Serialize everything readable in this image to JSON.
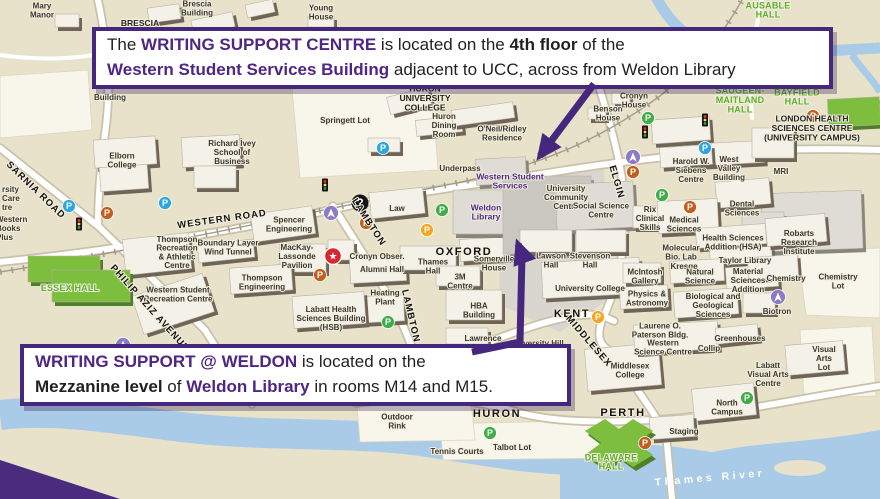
{
  "colors": {
    "purple": "#4F2683",
    "callout_border": "#46277E",
    "map_bg": "#E9E2CB",
    "river": "#A9CBE8",
    "green_label": "#5FAE2C",
    "building_shadow": "#6F6455",
    "parking_blue": "#2EA7E0",
    "parking_orange": "#C05F1E",
    "parking_yellow": "#F5A623",
    "parking_green": "#3FAE49",
    "info_purple": "#8B7CC4",
    "star_red": "#D7282F"
  },
  "callouts": {
    "top": {
      "lines": [
        [
          {
            "t": "The ",
            "s": "n"
          },
          {
            "t": "WRITING SUPPORT CENTRE",
            "s": "pb"
          },
          {
            "t": " is located on the ",
            "s": "n"
          },
          {
            "t": "4th floor",
            "s": "b"
          },
          {
            "t": " of the",
            "s": "n"
          }
        ],
        [
          {
            "t": "Western Student Services Building",
            "s": "pb"
          },
          {
            "t": " adjacent to UCC, across from Weldon Library",
            "s": "n"
          }
        ]
      ]
    },
    "bottom": {
      "lines": [
        [
          {
            "t": "WRITING SUPPORT @ WELDON",
            "s": "pb"
          },
          {
            "t": " is located on the",
            "s": "n"
          }
        ],
        [
          {
            "t": "Mezzanine level",
            "s": "b"
          },
          {
            "t": " of ",
            "s": "n"
          },
          {
            "t": "Weldon Library",
            "s": "pb"
          },
          {
            "t": " in rooms M14 and M15.",
            "s": "n"
          }
        ]
      ]
    }
  },
  "map_labels": [
    {
      "t": "Mary\nManor",
      "x": 42,
      "y": 10
    },
    {
      "t": "BRESCIA",
      "x": 140,
      "y": 23,
      "c": "bldgb"
    },
    {
      "t": "Brescia\nBuilding",
      "x": 197,
      "y": 8
    },
    {
      "t": "Young\nHouse",
      "x": 321,
      "y": 12
    },
    {
      "t": "Building",
      "x": 110,
      "y": 97
    },
    {
      "t": "AUSABLE\nHALL",
      "x": 768,
      "y": 10,
      "c": "green"
    },
    {
      "t": "SAUGEEN-\nMAITLAND\nHALL",
      "x": 740,
      "y": 100,
      "c": "green"
    },
    {
      "t": "BAYFIELD\nHALL",
      "x": 797,
      "y": 97,
      "c": "green"
    },
    {
      "t": "LONDON HEALTH\nSCIENCES CENTRE\n(UNIVERSITY CAMPUS)",
      "x": 812,
      "y": 128,
      "c": "bldgb"
    },
    {
      "t": "MRI",
      "x": 781,
      "y": 171
    },
    {
      "t": "West\nValley\nBuilding",
      "x": 729,
      "y": 168
    },
    {
      "t": "Harold W.\nSiebens\nCentre",
      "x": 691,
      "y": 170
    },
    {
      "t": "HURON\nUNIVERSITY\nCOLLEGE",
      "x": 425,
      "y": 98,
      "c": "bldgb"
    },
    {
      "t": "Springett Lot",
      "x": 345,
      "y": 120
    },
    {
      "t": "Huron\nDining\nRoom",
      "x": 444,
      "y": 125
    },
    {
      "t": "O'Neil/Ridley\nResidence",
      "x": 502,
      "y": 133
    },
    {
      "t": "Underpass",
      "x": 460,
      "y": 168
    },
    {
      "t": "Benson\nHouse",
      "x": 608,
      "y": 113
    },
    {
      "t": "Cronyn\nHouse",
      "x": 634,
      "y": 100
    },
    {
      "t": "Western Student\nServices",
      "x": 510,
      "y": 181,
      "c": "purple"
    },
    {
      "t": "University\nCommunity\nCentre",
      "x": 566,
      "y": 197
    },
    {
      "t": "Weldon\nLibrary",
      "x": 486,
      "y": 212,
      "c": "purple"
    },
    {
      "t": "Social Science\nCentre",
      "x": 601,
      "y": 210
    },
    {
      "t": "rsity\nCare\ntre",
      "x": 2,
      "y": 198,
      "c": "anchor-s"
    },
    {
      "t": "Western\nBooks\nPlus",
      "x": -4,
      "y": 228,
      "c": "anchor-s"
    },
    {
      "t": "Elborn\nCollege",
      "x": 122,
      "y": 160
    },
    {
      "t": "Richard Ivey\nSchool of\nBusiness",
      "x": 232,
      "y": 152
    },
    {
      "t": "Spencer\nEngineering",
      "x": 289,
      "y": 224
    },
    {
      "t": "Boundary Layer\nWind Tunnel",
      "x": 228,
      "y": 247
    },
    {
      "t": "Thompson\nRecreation\n& Athletic\nCentre",
      "x": 177,
      "y": 252
    },
    {
      "t": "MacKay-\nLassonde\nPavilion",
      "x": 297,
      "y": 256
    },
    {
      "t": "Thompson\nEngineering",
      "x": 262,
      "y": 282
    },
    {
      "t": "Western Student\nRecreation Centre",
      "x": 178,
      "y": 294
    },
    {
      "t": "Cronyn Obser.",
      "x": 377,
      "y": 256
    },
    {
      "t": "Alumni Hall",
      "x": 382,
      "y": 269
    },
    {
      "t": "Law",
      "x": 397,
      "y": 208
    },
    {
      "t": "Heating\nPlant",
      "x": 385,
      "y": 297
    },
    {
      "t": "Labatt Health\nSciences Building\n(HSB)",
      "x": 331,
      "y": 318
    },
    {
      "t": "ESSEX HALL",
      "x": 70,
      "y": 288,
      "c": "green"
    },
    {
      "t": "Thames\nHall",
      "x": 433,
      "y": 266
    },
    {
      "t": "3M\nCentre",
      "x": 460,
      "y": 281
    },
    {
      "t": "Somerville\nHouse",
      "x": 494,
      "y": 263
    },
    {
      "t": "HBA\nBuilding",
      "x": 479,
      "y": 310
    },
    {
      "t": "Lawrence",
      "x": 483,
      "y": 338
    },
    {
      "t": "University Hill",
      "x": 537,
      "y": 343
    },
    {
      "t": "Lawson\nHall",
      "x": 551,
      "y": 260
    },
    {
      "t": "Stevenson\nHall",
      "x": 590,
      "y": 260
    },
    {
      "t": "University College",
      "x": 590,
      "y": 288
    },
    {
      "t": "Rix\nClinical\nSkills",
      "x": 650,
      "y": 218
    },
    {
      "t": "Medical\nSciences",
      "x": 684,
      "y": 224
    },
    {
      "t": "Dental\nSciences",
      "x": 742,
      "y": 208
    },
    {
      "t": "Health Sciences\nAddition (HSA)",
      "x": 733,
      "y": 242
    },
    {
      "t": "Molecular\nBio. Lab",
      "x": 681,
      "y": 252
    },
    {
      "t": "Kresge",
      "x": 684,
      "y": 266
    },
    {
      "t": "Taylor Library",
      "x": 745,
      "y": 260
    },
    {
      "t": "Natural\nScience",
      "x": 700,
      "y": 276
    },
    {
      "t": "Material\nSciences\nAddition",
      "x": 748,
      "y": 280
    },
    {
      "t": "McIntosh\nGallery",
      "x": 645,
      "y": 276
    },
    {
      "t": "Physics &\nAstronomy",
      "x": 647,
      "y": 298
    },
    {
      "t": "Biological and\nGeological\nSciences",
      "x": 713,
      "y": 305
    },
    {
      "t": "Chemistry",
      "x": 786,
      "y": 278
    },
    {
      "t": "Chemistry\nLot",
      "x": 838,
      "y": 281
    },
    {
      "t": "Robarts\nResearch\nInstitute",
      "x": 799,
      "y": 242
    },
    {
      "t": "Biotron",
      "x": 777,
      "y": 311
    },
    {
      "t": "Greenhouses",
      "x": 740,
      "y": 338
    },
    {
      "t": "Collip",
      "x": 709,
      "y": 348
    },
    {
      "t": "Laurene O.\nPaterson Bldg.",
      "x": 660,
      "y": 330
    },
    {
      "t": "Western\nScience Centre",
      "x": 663,
      "y": 347
    },
    {
      "t": "Middlesex\nCollege",
      "x": 630,
      "y": 370
    },
    {
      "t": "Labatt\nVisual Arts\nCentre",
      "x": 768,
      "y": 374
    },
    {
      "t": "Visual\nArts\nLot",
      "x": 824,
      "y": 358
    },
    {
      "t": "North\nCampus",
      "x": 727,
      "y": 407
    },
    {
      "t": "Staging",
      "x": 684,
      "y": 431
    },
    {
      "t": "DELAWARE\nHALL",
      "x": 611,
      "y": 462,
      "c": "green"
    },
    {
      "t": "Talbot Lot",
      "x": 512,
      "y": 447
    },
    {
      "t": "Tennis Courts",
      "x": 457,
      "y": 451
    },
    {
      "t": "Outdoor\nRink",
      "x": 397,
      "y": 421
    },
    {
      "t": "SARNIA ROAD",
      "x": 36,
      "y": 190,
      "c": "road",
      "r": 44
    },
    {
      "t": "WESTERN ROAD",
      "x": 222,
      "y": 219,
      "c": "road",
      "r": -8
    },
    {
      "t": "PHILIP AZIZ AVENUE",
      "x": 150,
      "y": 308,
      "c": "road",
      "r": 48
    },
    {
      "t": "LAMBTON",
      "x": 369,
      "y": 222,
      "c": "road",
      "r": 57
    },
    {
      "t": "LAMBTON",
      "x": 411,
      "y": 316,
      "c": "road",
      "r": 77
    },
    {
      "t": "OXFORD",
      "x": 464,
      "y": 252,
      "c": "roadlg"
    },
    {
      "t": "ELGIN",
      "x": 617,
      "y": 182,
      "c": "road",
      "r": 74
    },
    {
      "t": "KENT",
      "x": 572,
      "y": 314,
      "c": "roadlg"
    },
    {
      "t": "MIDDLESEX",
      "x": 589,
      "y": 341,
      "c": "road",
      "r": 49
    },
    {
      "t": "HURON",
      "x": 497,
      "y": 414,
      "c": "roadlg"
    },
    {
      "t": "PERTH",
      "x": 623,
      "y": 413,
      "c": "roadlg"
    },
    {
      "t": "Thames River",
      "x": 710,
      "y": 478,
      "c": "river",
      "r": -5
    }
  ],
  "icons": [
    {
      "k": "p",
      "c": "blue",
      "x": 69,
      "y": 206
    },
    {
      "k": "p",
      "c": "blue",
      "x": 165,
      "y": 203
    },
    {
      "k": "p",
      "c": "blue",
      "x": 383,
      "y": 148
    },
    {
      "k": "p",
      "c": "blue",
      "x": 705,
      "y": 148
    },
    {
      "k": "p",
      "c": "orange",
      "x": 107,
      "y": 213
    },
    {
      "k": "p",
      "c": "orange",
      "x": 366,
      "y": 223
    },
    {
      "k": "p",
      "c": "orange",
      "x": 320,
      "y": 275
    },
    {
      "k": "p",
      "c": "orange",
      "x": 633,
      "y": 172
    },
    {
      "k": "p",
      "c": "orange",
      "x": 690,
      "y": 207
    },
    {
      "k": "p",
      "c": "orange",
      "x": 813,
      "y": 116
    },
    {
      "k": "p",
      "c": "orange",
      "x": 645,
      "y": 443
    },
    {
      "k": "p",
      "c": "yellow",
      "x": 427,
      "y": 230
    },
    {
      "k": "p",
      "c": "yellow",
      "x": 598,
      "y": 317
    },
    {
      "k": "p",
      "c": "green",
      "x": 442,
      "y": 210
    },
    {
      "k": "p",
      "c": "green",
      "x": 388,
      "y": 322
    },
    {
      "k": "p",
      "c": "green",
      "x": 490,
      "y": 433
    },
    {
      "k": "p",
      "c": "green",
      "x": 648,
      "y": 118
    },
    {
      "k": "p",
      "c": "green",
      "x": 662,
      "y": 195
    },
    {
      "k": "p",
      "c": "green",
      "x": 747,
      "y": 398
    },
    {
      "k": "i",
      "x": 331,
      "y": 213
    },
    {
      "k": "i",
      "x": 123,
      "y": 345
    },
    {
      "k": "i",
      "x": 633,
      "y": 157
    },
    {
      "k": "i",
      "x": 778,
      "y": 297
    },
    {
      "k": "q",
      "x": 360,
      "y": 203
    },
    {
      "k": "s",
      "x": 333,
      "y": 256
    },
    {
      "k": "t",
      "x": 79,
      "y": 224
    },
    {
      "k": "t",
      "x": 325,
      "y": 185
    },
    {
      "k": "t",
      "x": 645,
      "y": 132
    },
    {
      "k": "t",
      "x": 705,
      "y": 120
    }
  ]
}
